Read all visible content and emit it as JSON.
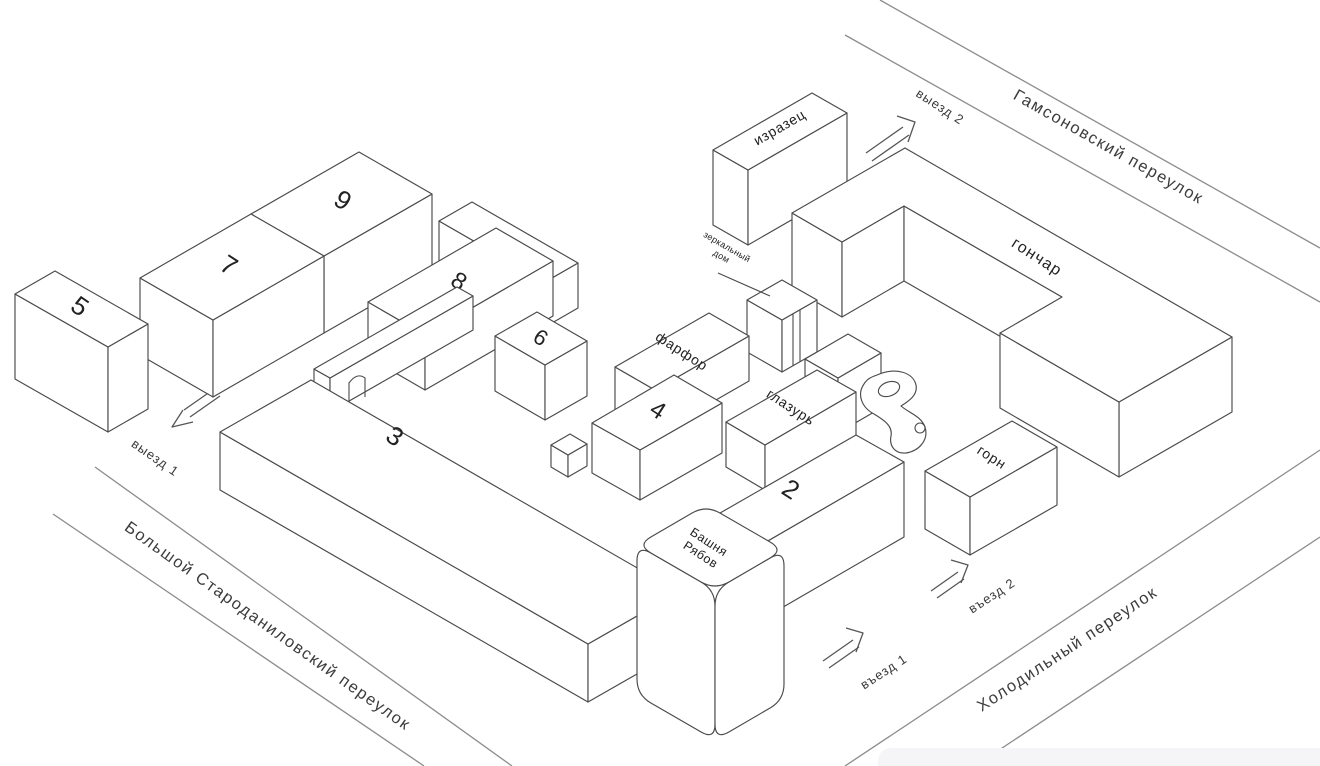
{
  "map": {
    "streets": {
      "gamsonovsky": "Гамсоновский переулок",
      "starodanilovsky": "Большой Староданиловский переулок",
      "kholodilny": "Холодильный переулок"
    },
    "gates": {
      "exit1": "выезд 1",
      "exit2": "выезд 2",
      "entry1": "въезд 1",
      "entry2": "въезд 2"
    },
    "buildings": {
      "b2": "2",
      "b3": "3",
      "b4": "4",
      "b5": "5",
      "b6": "6",
      "b7": "7",
      "b8": "8",
      "b9": "9",
      "b10": "10",
      "izrazets": "изразец",
      "farfor": "фарфор",
      "glazur": "глазурь",
      "gonchar": "гончар",
      "gorn": "горн",
      "mirror_house": {
        "line1": "зеркальный",
        "line2": "дом"
      },
      "tower": {
        "line1": "Башня",
        "line2": "Рябов"
      }
    }
  }
}
